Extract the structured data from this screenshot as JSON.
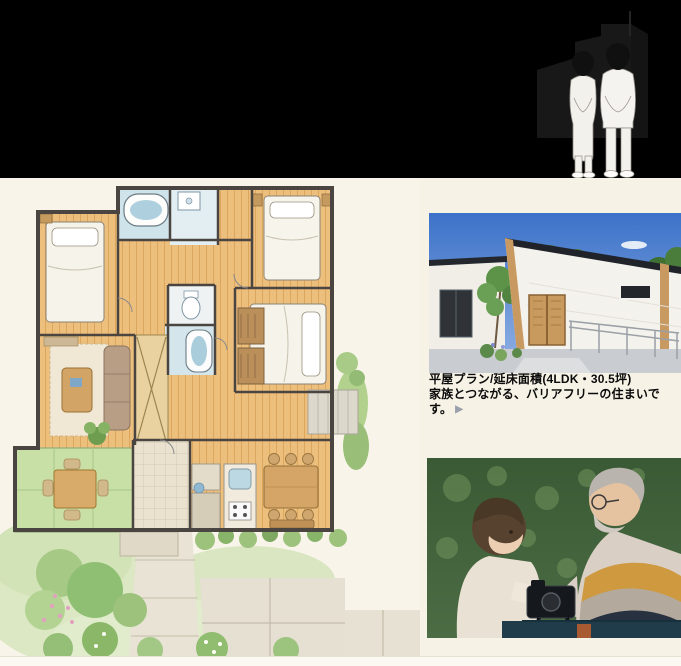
{
  "page": {
    "width_px": 681,
    "height_px": 666,
    "background_color": "#f6f2e6",
    "header_color": "#000000"
  },
  "header": {
    "illustration": "elderly-couple-standing-in-front-of-single-story-house-sketch"
  },
  "floor_plan": {
    "illustration": "watercolor-floor-plan-with-garden",
    "palette": {
      "wood_floor": "#edbf7d",
      "bath_blue": "#cfe4ea",
      "tatami_green": "#c8dfa6",
      "garden_green": "#a6ca85",
      "wall_gray": "#4a4540",
      "path_beige": "#e8e3d4"
    }
  },
  "right_column": {
    "exterior_photo": "single-story-house-exterior-with-entrance-ramp",
    "caption": {
      "line1": "平屋プラン/延床面積(4LDK・30.5坪)",
      "line2": "家族とつながる、バリアフリーの住まいです。",
      "arrow": "▶"
    },
    "family_photo": "grandfather-and-granddaughter-looking-at-camera-outdoors"
  }
}
